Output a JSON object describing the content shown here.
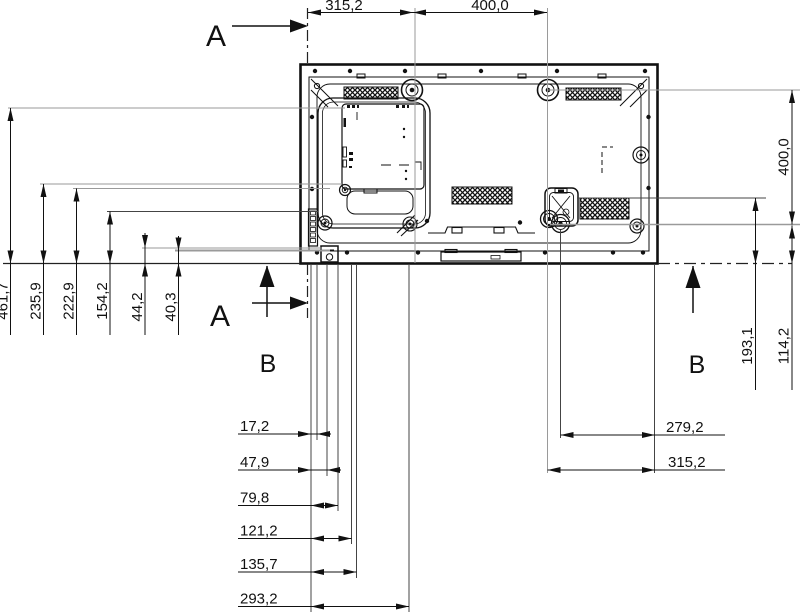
{
  "drawing": {
    "type": "technical-dimension-drawing",
    "subject": "flat-panel display rear view with mounting dimensions",
    "units_style": "comma-decimal-millimeters",
    "colors": {
      "line": "#1a1a1a",
      "construction": "#9a9a9a",
      "background": "#ffffff"
    },
    "sections": {
      "a": "A",
      "b": "B"
    },
    "dims": {
      "top": [
        "315,2",
        "400,0"
      ],
      "left": [
        "461,7",
        "235,9",
        "222,9",
        "154,2",
        "44,2",
        "40,3"
      ],
      "right": [
        "400,0",
        "193,1",
        "114,2"
      ],
      "bottom_left": [
        "17,2",
        "47,9",
        "79,8",
        "121,2",
        "135,7",
        "293,2"
      ],
      "bottom_right": [
        "279,2",
        "315,2"
      ]
    },
    "features": [
      "vesa-mount-bosses",
      "vent-grilles",
      "connector-bay",
      "wall-bracket-hook",
      "ac-inlet",
      "stand-rail",
      "section-line-A",
      "section-line-B"
    ]
  }
}
